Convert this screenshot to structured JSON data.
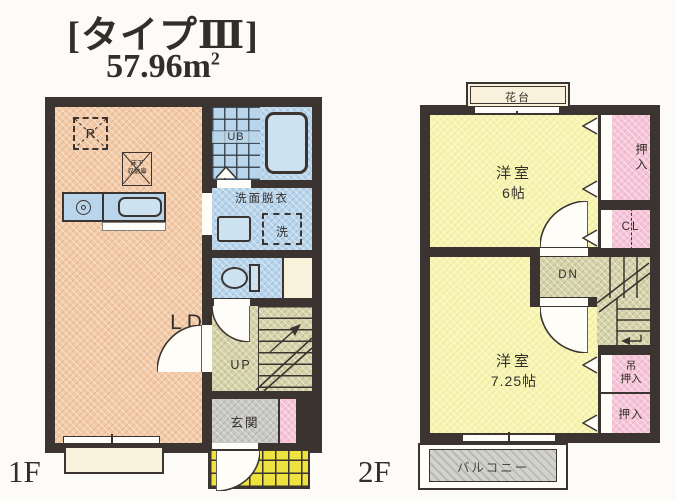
{
  "title": {
    "type": "[タイプⅢ]",
    "area": "57.96m",
    "area_exponent": "2"
  },
  "floor1": {
    "label": "1F",
    "ldk_name": "LDK",
    "ldk_size": "10.5帖",
    "fridge": "R",
    "floor_storage_line1": "床下",
    "floor_storage_line2": "収納庫",
    "unit_bath": "UB",
    "washroom": "洗面脱衣",
    "washer": "洗",
    "stairs_direction": "UP",
    "entrance": "玄関"
  },
  "floor2": {
    "label": "2F",
    "flower_shelf": "花台",
    "room6_name": "洋室",
    "room6_size": "6帖",
    "closet_top": "押入",
    "closet_cl": "CL",
    "stairs_direction": "DN",
    "room725_name": "洋室",
    "room725_size": "7.25帖",
    "hanging_closet_line1": "吊",
    "hanging_closet_line2": "押入",
    "closet_bottom": "押入",
    "balcony": "バルコニー"
  },
  "colors": {
    "paper": "#fcfbf7",
    "wall": "#3b3430",
    "ink": "#332e2a",
    "ldk": "#f3cba9",
    "wet": "#b9d5eb",
    "fixture": "#cde2f1",
    "stair": "#d6d3aa",
    "closet": "#f6c6d8",
    "bedroom": "#f8f5b1",
    "porch": "#ede23e",
    "entrance": "#c8c8c4",
    "balcony": "#d2d2cd",
    "terrace": "#faf1dd",
    "gap": "#fffdf8"
  }
}
